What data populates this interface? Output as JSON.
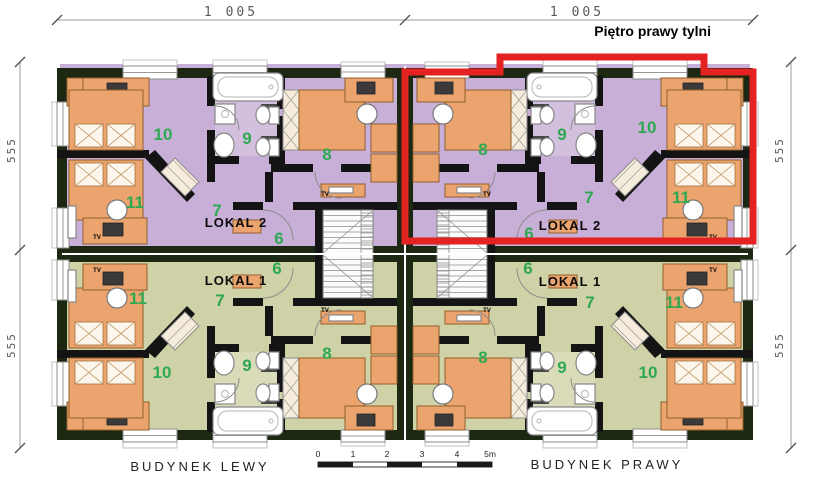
{
  "title": "Piętro prawy tylni",
  "dimensions": {
    "top_left": "1 005",
    "top_right": "1 005",
    "side_left_upper": "555",
    "side_left_lower": "555",
    "side_right_upper": "555",
    "side_right_lower": "555"
  },
  "buildings": {
    "left": {
      "label": "BUDYNEK  LEWY",
      "lokal2": {
        "label": "LOKAL 2",
        "rooms": [
          "10",
          "9",
          "8",
          "11",
          "7",
          "6"
        ]
      },
      "lokal1": {
        "label": "LOKAL 1",
        "rooms": [
          "6",
          "7",
          "11",
          "10",
          "9",
          "8"
        ]
      }
    },
    "right": {
      "label": "BUDYNEK  PRAWY",
      "lokal2": {
        "label": "LOKAL 2",
        "rooms": [
          "8",
          "9",
          "10",
          "7",
          "11",
          "6"
        ]
      },
      "lokal1": {
        "label": "LOKAL 1",
        "rooms": [
          "6",
          "7",
          "11",
          "8",
          "9",
          "10"
        ]
      }
    }
  },
  "scale_bar": {
    "ticks": [
      "0",
      "1",
      "2",
      "3",
      "4",
      "5m"
    ]
  },
  "labels": {
    "tv": "TV"
  },
  "colors": {
    "highlight_red": "#e32222",
    "floor_lokal2_purple": "#c7afd7",
    "floor_lokal1_olive": "#cfd1a6",
    "room_number_green": "#2fa852",
    "furniture_orange": "#eca46f",
    "wall_dark": "#1c2812"
  }
}
